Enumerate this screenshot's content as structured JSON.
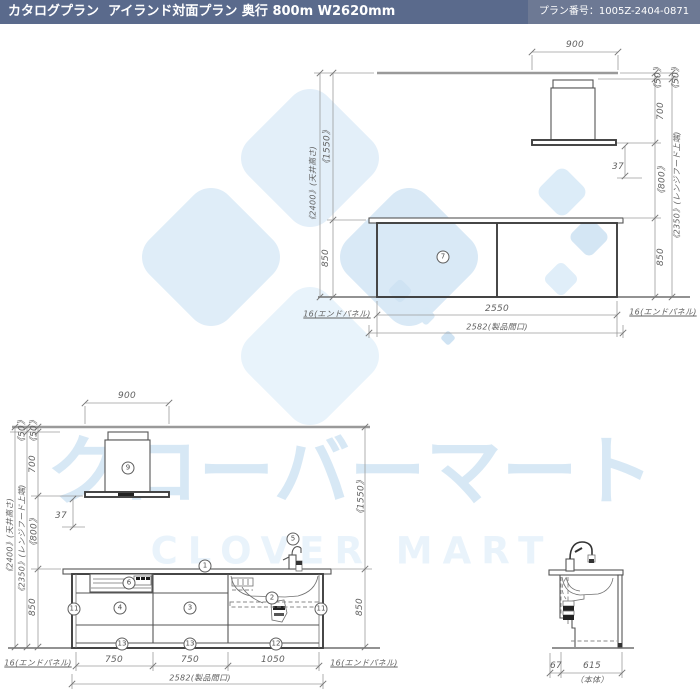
{
  "header": {
    "title": "カタログプラン  アイランド対面プラン 奥行 800m W2620mm",
    "plan_number": "プラン番号：1005Z-2404-0871"
  },
  "watermark": {
    "katakana": "クローバーマート",
    "latin": "CLOVER MART"
  },
  "colors": {
    "header_left": "#5a6a8c",
    "header_right": "#6d7994",
    "watermark_blue": "#d7e8f5",
    "drawing_line": "#3e3e3e",
    "dimension_text": "#616161"
  },
  "views": {
    "rear_view": {
      "labels": [
        {
          "text": "900",
          "x": 575,
          "y": 45
        },
        {
          "text": "《1550》",
          "x": 326,
          "y": 147,
          "rot": 1
        },
        {
          "text": "850",
          "x": 326,
          "y": 258,
          "rot": 1
        },
        {
          "text": "《2400》(天井高さ)",
          "x": 313,
          "y": 185,
          "rot": 1,
          "jp": 1
        },
        {
          "text": "《50》",
          "x": 657,
          "y": 78,
          "rot": 1
        },
        {
          "text": "《50》",
          "x": 675,
          "y": 78,
          "rot": 1
        },
        {
          "text": "700",
          "x": 661,
          "y": 111,
          "rot": 1
        },
        {
          "text": "《800》",
          "x": 661,
          "y": 180,
          "rot": 1
        },
        {
          "text": "850",
          "x": 661,
          "y": 257,
          "rot": 1
        },
        {
          "text": "《2350》(レンジフード上端)",
          "x": 677,
          "y": 187,
          "rot": 1,
          "jp": 1
        },
        {
          "text": "37",
          "x": 618,
          "y": 167
        },
        {
          "text": "2550",
          "x": 497,
          "y": 309
        },
        {
          "text": "2582(製品間口)",
          "x": 497,
          "y": 327,
          "jp": 1
        },
        {
          "text": "16(エンドパネル)",
          "x": 337,
          "y": 314,
          "jp": 1,
          "u": 1
        },
        {
          "text": "16(エンドパネル)",
          "x": 663,
          "y": 312,
          "jp": 1,
          "u": 1
        }
      ],
      "callouts": [
        {
          "n": "7",
          "x": 443,
          "y": 257
        }
      ]
    },
    "front_view": {
      "labels": [
        {
          "text": "900",
          "x": 127,
          "y": 396
        },
        {
          "text": "《50》",
          "x": 21,
          "y": 431,
          "rot": 1
        },
        {
          "text": "《50》",
          "x": 33,
          "y": 431,
          "rot": 1
        },
        {
          "text": "700",
          "x": 33,
          "y": 464,
          "rot": 1
        },
        {
          "text": "《800》",
          "x": 33,
          "y": 532,
          "rot": 1
        },
        {
          "text": "850",
          "x": 33,
          "y": 607,
          "rot": 1
        },
        {
          "text": "《2400》(天井高さ)",
          "x": 10,
          "y": 537,
          "rot": 1,
          "jp": 1
        },
        {
          "text": "《2350》(レンジフード上端)",
          "x": 22,
          "y": 540,
          "rot": 1,
          "jp": 1
        },
        {
          "text": "37",
          "x": 61,
          "y": 516
        },
        {
          "text": "《1550》",
          "x": 360,
          "y": 497,
          "rot": 1
        },
        {
          "text": "850",
          "x": 360,
          "y": 607,
          "rot": 1
        },
        {
          "text": "750",
          "x": 114,
          "y": 660
        },
        {
          "text": "750",
          "x": 190,
          "y": 660
        },
        {
          "text": "1050",
          "x": 273,
          "y": 660
        },
        {
          "text": "2582(製品間口)",
          "x": 200,
          "y": 678,
          "jp": 1
        },
        {
          "text": "16(エンドパネル)",
          "x": 38,
          "y": 663,
          "jp": 1,
          "u": 1
        },
        {
          "text": "16(エンドパネル)",
          "x": 364,
          "y": 663,
          "jp": 1,
          "u": 1
        }
      ],
      "callouts": [
        {
          "n": "9",
          "x": 128,
          "y": 468
        },
        {
          "n": "1",
          "x": 205,
          "y": 566
        },
        {
          "n": "5",
          "x": 293,
          "y": 539
        },
        {
          "n": "6",
          "x": 129,
          "y": 583
        },
        {
          "n": "4",
          "x": 120,
          "y": 608
        },
        {
          "n": "3",
          "x": 190,
          "y": 608
        },
        {
          "n": "2",
          "x": 272,
          "y": 598
        },
        {
          "n": "11",
          "x": 74,
          "y": 609
        },
        {
          "n": "11",
          "x": 321,
          "y": 609
        },
        {
          "n": "13",
          "x": 122,
          "y": 644
        },
        {
          "n": "13",
          "x": 190,
          "y": 644
        },
        {
          "n": "12",
          "x": 276,
          "y": 644
        }
      ]
    },
    "side_view": {
      "labels": [
        {
          "text": "67",
          "x": 556,
          "y": 666
        },
        {
          "text": "615",
          "x": 592,
          "y": 666
        },
        {
          "text": "（本体）",
          "x": 592,
          "y": 680,
          "jp": 1
        }
      ],
      "callouts": []
    }
  }
}
